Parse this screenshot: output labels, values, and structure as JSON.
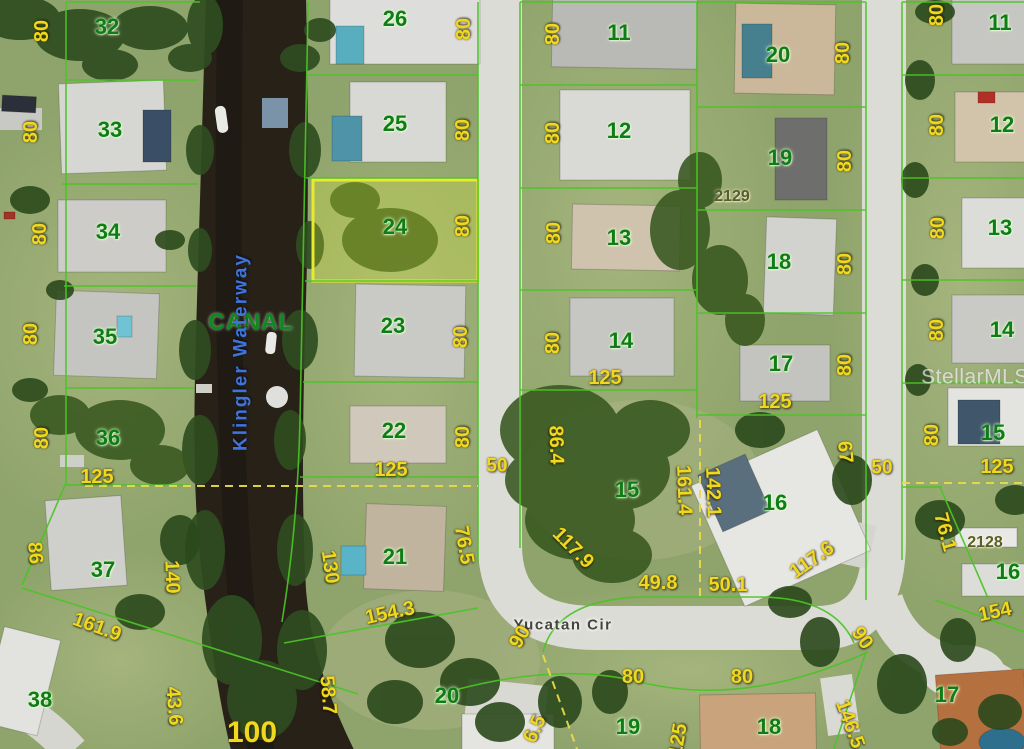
{
  "map": {
    "watermark": "StellarMLS",
    "canal_label": "CANAL",
    "waterway_label": "Klingler Waterway",
    "street_label": "Yucatan Cir",
    "highlighted_lot": "24",
    "colors": {
      "parcel_line": "#4cc426",
      "highlight": "#e9e930",
      "dimension_text": "#f0d81e",
      "lot_text": "#0f7c15",
      "water": "#272118",
      "road": "#dcdcd7"
    },
    "lot_numbers": [
      {
        "t": "32",
        "x": 107,
        "y": 27
      },
      {
        "t": "33",
        "x": 110,
        "y": 130
      },
      {
        "t": "34",
        "x": 108,
        "y": 232
      },
      {
        "t": "35",
        "x": 105,
        "y": 337
      },
      {
        "t": "36",
        "x": 108,
        "y": 438
      },
      {
        "t": "37",
        "x": 103,
        "y": 570
      },
      {
        "t": "38",
        "x": 40,
        "y": 700
      },
      {
        "t": "26",
        "x": 395,
        "y": 19
      },
      {
        "t": "25",
        "x": 395,
        "y": 124
      },
      {
        "t": "24",
        "x": 395,
        "y": 227
      },
      {
        "t": "23",
        "x": 393,
        "y": 326
      },
      {
        "t": "22",
        "x": 394,
        "y": 431
      },
      {
        "t": "21",
        "x": 395,
        "y": 557
      },
      {
        "t": "20",
        "x": 447,
        "y": 696
      },
      {
        "t": "11",
        "x": 619,
        "y": 33
      },
      {
        "t": "12",
        "x": 619,
        "y": 131
      },
      {
        "t": "13",
        "x": 619,
        "y": 238
      },
      {
        "t": "14",
        "x": 621,
        "y": 341
      },
      {
        "t": "15",
        "x": 627,
        "y": 490
      },
      {
        "t": "16",
        "x": 775,
        "y": 503
      },
      {
        "t": "20",
        "x": 778,
        "y": 55
      },
      {
        "t": "19",
        "x": 780,
        "y": 158
      },
      {
        "t": "18",
        "x": 779,
        "y": 262
      },
      {
        "t": "17",
        "x": 781,
        "y": 364
      },
      {
        "t": "19",
        "x": 628,
        "y": 727
      },
      {
        "t": "18",
        "x": 769,
        "y": 727
      },
      {
        "t": "11",
        "x": 1000,
        "y": 23
      },
      {
        "t": "12",
        "x": 1002,
        "y": 125
      },
      {
        "t": "13",
        "x": 1000,
        "y": 228
      },
      {
        "t": "14",
        "x": 1002,
        "y": 330
      },
      {
        "t": "15",
        "x": 993,
        "y": 433
      },
      {
        "t": "16",
        "x": 1008,
        "y": 572
      },
      {
        "t": "17",
        "x": 947,
        "y": 695
      }
    ],
    "house_numbers": [
      {
        "t": "2129",
        "x": 732,
        "y": 197
      },
      {
        "t": "2128",
        "x": 985,
        "y": 543
      }
    ],
    "dimensions": [
      {
        "t": "80",
        "x": 42,
        "y": 31,
        "r": -90
      },
      {
        "t": "80",
        "x": 31,
        "y": 132,
        "r": -90
      },
      {
        "t": "80",
        "x": 40,
        "y": 234,
        "r": -90
      },
      {
        "t": "80",
        "x": 31,
        "y": 334,
        "r": -90
      },
      {
        "t": "80",
        "x": 42,
        "y": 438,
        "r": -90
      },
      {
        "t": "86",
        "x": 35,
        "y": 553,
        "r": 85
      },
      {
        "t": "140",
        "x": 172,
        "y": 577,
        "r": 88
      },
      {
        "t": "125",
        "x": 97,
        "y": 477,
        "r": 0
      },
      {
        "t": "161.9",
        "x": 97,
        "y": 627,
        "r": 20
      },
      {
        "t": "43.6",
        "x": 174,
        "y": 706,
        "r": 85
      },
      {
        "t": "100",
        "x": 252,
        "y": 733,
        "r": 0,
        "s": 30
      },
      {
        "t": "58.7",
        "x": 328,
        "y": 695,
        "r": 85
      },
      {
        "t": "130",
        "x": 330,
        "y": 567,
        "r": 82
      },
      {
        "t": "154.3",
        "x": 390,
        "y": 613,
        "r": -12
      },
      {
        "t": "80",
        "x": 464,
        "y": 29,
        "r": -90
      },
      {
        "t": "80",
        "x": 463,
        "y": 130,
        "r": -90
      },
      {
        "t": "80",
        "x": 463,
        "y": 226,
        "r": -90
      },
      {
        "t": "80",
        "x": 461,
        "y": 337,
        "r": -90
      },
      {
        "t": "80",
        "x": 463,
        "y": 437,
        "r": -90
      },
      {
        "t": "125",
        "x": 391,
        "y": 470,
        "r": 0
      },
      {
        "t": "76.5",
        "x": 464,
        "y": 545,
        "r": 80
      },
      {
        "t": "90",
        "x": 520,
        "y": 637,
        "r": -60
      },
      {
        "t": "6.5",
        "x": 535,
        "y": 729,
        "r": -65
      },
      {
        "t": "50",
        "x": 497,
        "y": 466,
        "r": 0,
        "s": 19
      },
      {
        "t": "50",
        "x": 882,
        "y": 468,
        "r": 0,
        "s": 19
      },
      {
        "t": "80",
        "x": 553,
        "y": 34,
        "r": -90
      },
      {
        "t": "80",
        "x": 553,
        "y": 133,
        "r": -90
      },
      {
        "t": "80",
        "x": 554,
        "y": 233,
        "r": -90
      },
      {
        "t": "80",
        "x": 553,
        "y": 343,
        "r": -90
      },
      {
        "t": "125",
        "x": 605,
        "y": 378,
        "r": 0
      },
      {
        "t": "86.4",
        "x": 556,
        "y": 445,
        "r": 88
      },
      {
        "t": "117.9",
        "x": 573,
        "y": 548,
        "r": 45
      },
      {
        "t": "161.4",
        "x": 684,
        "y": 490,
        "r": 88
      },
      {
        "t": "142.1",
        "x": 713,
        "y": 492,
        "r": 88
      },
      {
        "t": "49.8",
        "x": 658,
        "y": 583,
        "r": 0
      },
      {
        "t": "50.1",
        "x": 728,
        "y": 585,
        "r": 0
      },
      {
        "t": "117.6",
        "x": 812,
        "y": 560,
        "r": -35
      },
      {
        "t": "67",
        "x": 845,
        "y": 452,
        "r": 85
      },
      {
        "t": "90",
        "x": 862,
        "y": 638,
        "r": 55
      },
      {
        "t": "80",
        "x": 633,
        "y": 677,
        "r": 0
      },
      {
        "t": "80",
        "x": 742,
        "y": 677,
        "r": 0
      },
      {
        "t": "125",
        "x": 678,
        "y": 740,
        "r": -80
      },
      {
        "t": "146.5",
        "x": 850,
        "y": 724,
        "r": 70
      },
      {
        "t": "80",
        "x": 843,
        "y": 53,
        "r": -90
      },
      {
        "t": "80",
        "x": 845,
        "y": 161,
        "r": -90
      },
      {
        "t": "80",
        "x": 845,
        "y": 264,
        "r": -90
      },
      {
        "t": "80",
        "x": 845,
        "y": 365,
        "r": -90
      },
      {
        "t": "125",
        "x": 775,
        "y": 402,
        "r": 0
      },
      {
        "t": "80",
        "x": 937,
        "y": 15,
        "r": -90
      },
      {
        "t": "80",
        "x": 937,
        "y": 125,
        "r": -90
      },
      {
        "t": "80",
        "x": 938,
        "y": 228,
        "r": -90
      },
      {
        "t": "80",
        "x": 937,
        "y": 330,
        "r": -90
      },
      {
        "t": "80",
        "x": 932,
        "y": 435,
        "r": -90
      },
      {
        "t": "125",
        "x": 997,
        "y": 467,
        "r": 0
      },
      {
        "t": "76.1",
        "x": 945,
        "y": 532,
        "r": 75
      },
      {
        "t": "154",
        "x": 995,
        "y": 612,
        "r": -12
      }
    ]
  }
}
